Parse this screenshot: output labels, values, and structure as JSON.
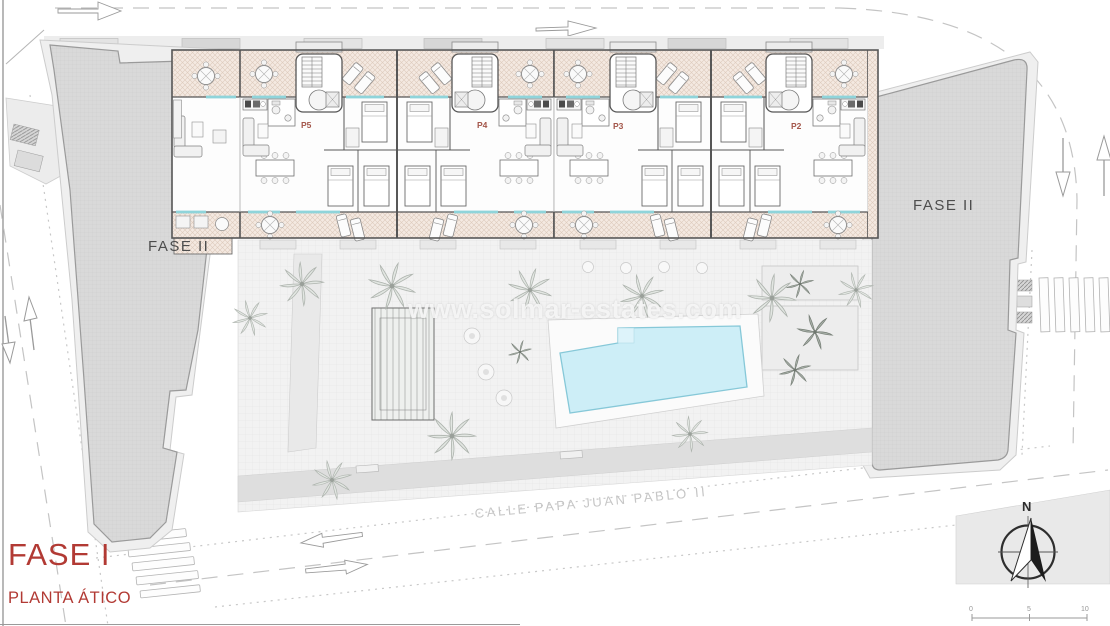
{
  "page": {
    "watermark": "www.solmar-estates.com"
  },
  "title_block": {
    "phase_label": "FASE I",
    "floor_label": "PLANTA ÁTICO",
    "accent_color": "#b23a34"
  },
  "buildings": {
    "left_block_label": "FASE II",
    "right_block_label": "FASE II"
  },
  "street": {
    "name": "CALLE PAPA JUAN PABLO II"
  },
  "units": [
    {
      "id": "P5"
    },
    {
      "id": "P4"
    },
    {
      "id": "P3"
    },
    {
      "id": "P2"
    }
  ],
  "compass": {
    "north": "N"
  },
  "scale_bar": {
    "ticks": [
      "0",
      "5",
      "10"
    ]
  },
  "colors": {
    "terrace_hatch": "#f4e9e1",
    "pool_water": "#cdeef7",
    "block_fill": "#d9d9d9",
    "wall": "#565656",
    "glass_accent": "#8fd4da",
    "road_line": "#c4c4c4"
  }
}
